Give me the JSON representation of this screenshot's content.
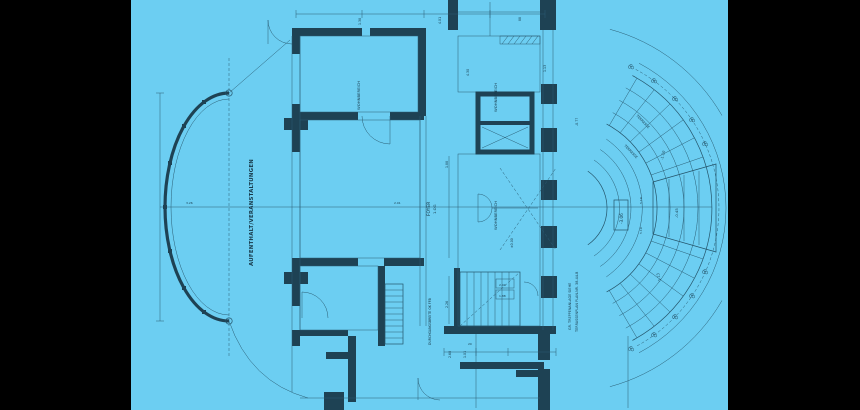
{
  "scene": {
    "description": "Blueprint floor plan, rotated 90deg, cyan paper with black pillarbox bars",
    "colors": {
      "letterbox": "#000000",
      "paper": "#6CCEF2",
      "ink": "#1E4254"
    }
  },
  "labels": {
    "room_main": "AUFENTHALT/VERANSTALTUNGEN",
    "room_top_left": "WOHNBEREICH",
    "room_top_right": "WOHNBEREICH",
    "room_mid_right": "WOHNBEREICH",
    "foyer_line1": "FOYER",
    "foyer_line2": "1.OG",
    "corridor_note": "DURCHGANGSBREITE OK FFB",
    "terrace_note1": "GR. TREPPENANLAGE SIEHE",
    "terrace_note2": "TERRASSENPLAN PLAN-NR. 38-44-B",
    "terrace1": "TERRASSE",
    "terrace2": "TERRASSE",
    "elev_box": "-3.06",
    "elev_upper": "-1.10",
    "elev_lower": "-1.13",
    "elev_landing": "-0.45",
    "elev_small": "-0.77",
    "elev_zero": "±0.00",
    "dim1": "1.38",
    "dim2": "4.30",
    "dim3": "1.88",
    "dim4": "2.26",
    "dim5": "5.19",
    "dim6": "5.19",
    "dim7": "2.68",
    "dim8": "1.01",
    "dim9": "2.01",
    "dim10": "4.01",
    "dim11": "1.13",
    "dim12": "88",
    "dim13": "20",
    "dim14": "3.26",
    "dim15": "2.04",
    "dim16": "1.88"
  }
}
